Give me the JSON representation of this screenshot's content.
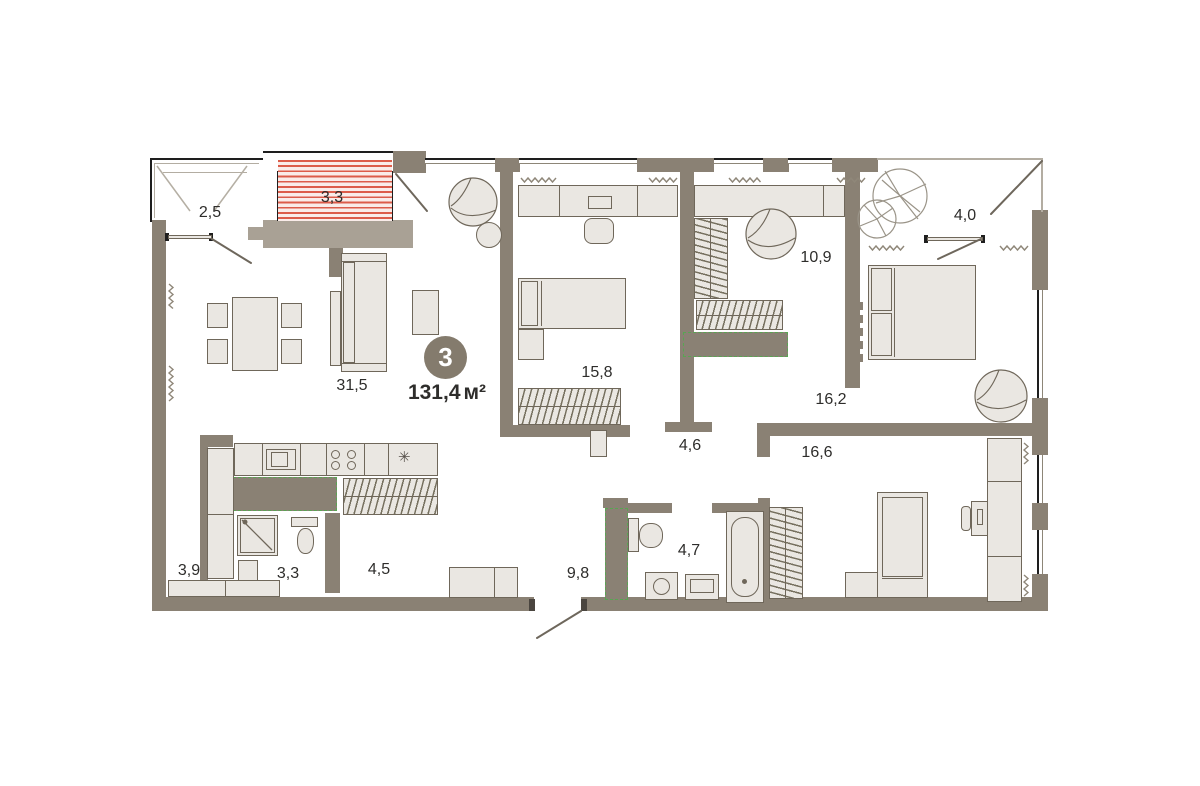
{
  "plan": {
    "badge": {
      "rooms_count": "3",
      "total_area": "131,4",
      "area_unit": "м²"
    },
    "rooms": [
      {
        "id": "balcony-left",
        "area": "2,5"
      },
      {
        "id": "balcony-hatched",
        "area": "3,3"
      },
      {
        "id": "living-room",
        "area": "31,5"
      },
      {
        "id": "bedroom-top",
        "area": "15,8"
      },
      {
        "id": "wardrobe-room",
        "area": "10,9"
      },
      {
        "id": "balcony-right",
        "area": "4,0"
      },
      {
        "id": "bedroom-right",
        "area": "16,2"
      },
      {
        "id": "hall-middle",
        "area": "4,6"
      },
      {
        "id": "bedroom-bottom",
        "area": "16,6"
      },
      {
        "id": "corridor-left",
        "area": "3,9"
      },
      {
        "id": "shower-room",
        "area": "3,3"
      },
      {
        "id": "hallway",
        "area": "4,5"
      },
      {
        "id": "entry-hall",
        "area": "9,8"
      },
      {
        "id": "bathroom",
        "area": "4,7"
      }
    ],
    "colors": {
      "wall": "#8a8174",
      "wall_light": "#a9a195",
      "furniture_fill": "#eae7e2",
      "furniture_line": "#6f675a",
      "storage_dash": "#58a552",
      "balcony_hatch": "#dc5c4a",
      "label_text": "#2e2d2b",
      "badge_bg": "#847b6d"
    }
  }
}
